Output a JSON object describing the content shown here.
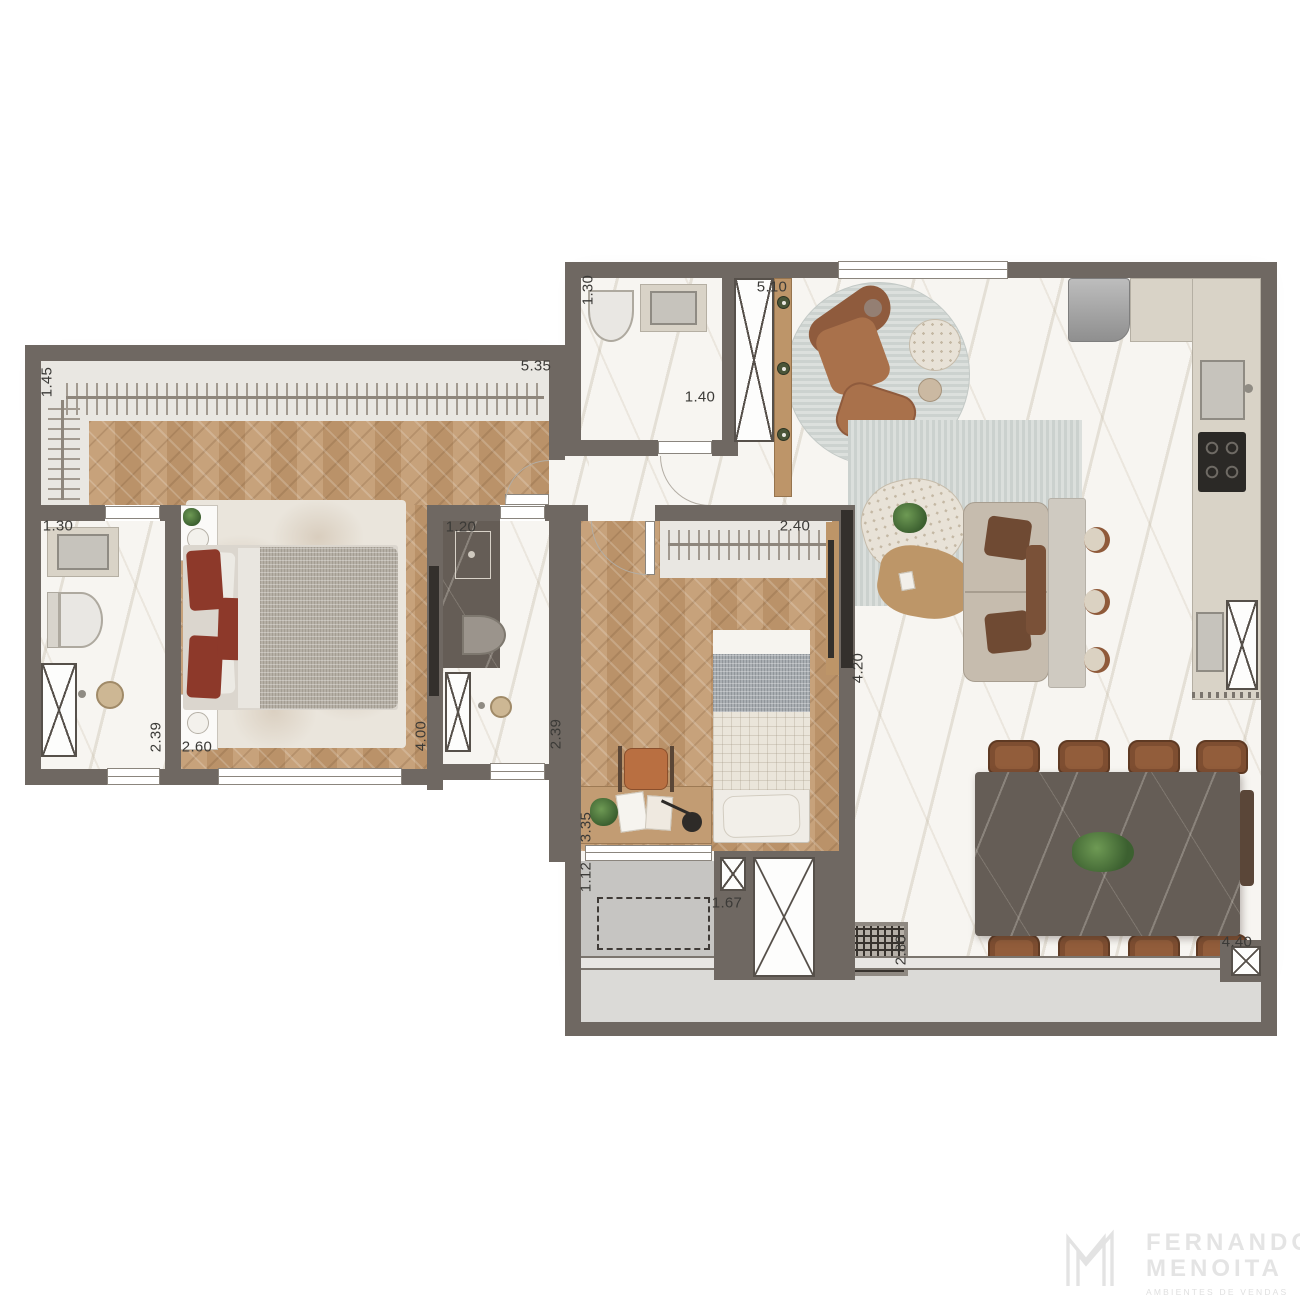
{
  "plan": {
    "dims": {
      "closet_master": "1.45",
      "suite_master": "5.35",
      "bath_master_w": "1.30",
      "bath_master_l": "2.39",
      "bed_master_w": "2.60",
      "bed_master_l": "4.00",
      "bath2_w": "1.20",
      "bath2_l": "2.39",
      "closet2": "2.40",
      "bedroom2_l": "3.35",
      "laundry_w": "1.12",
      "laundry_l": "1.67",
      "lavabo_w": "1.30",
      "lavabo_l": "1.40",
      "living_w": "5.10",
      "living_l": "4.20",
      "dining_w": "2.80",
      "dining_l": "4.40"
    },
    "colors": {
      "wall": "#6F6862",
      "wood_floor": "#C29C75",
      "marble_floor": "#F7F5F1",
      "accent_red": "#8D392A",
      "leather_brown": "#8F5A3A"
    }
  },
  "logo": {
    "monogram": "M",
    "line1": "FERNANDO",
    "line2": "MENOITA",
    "tagline": "AMBIENTES DE VENDAS"
  }
}
